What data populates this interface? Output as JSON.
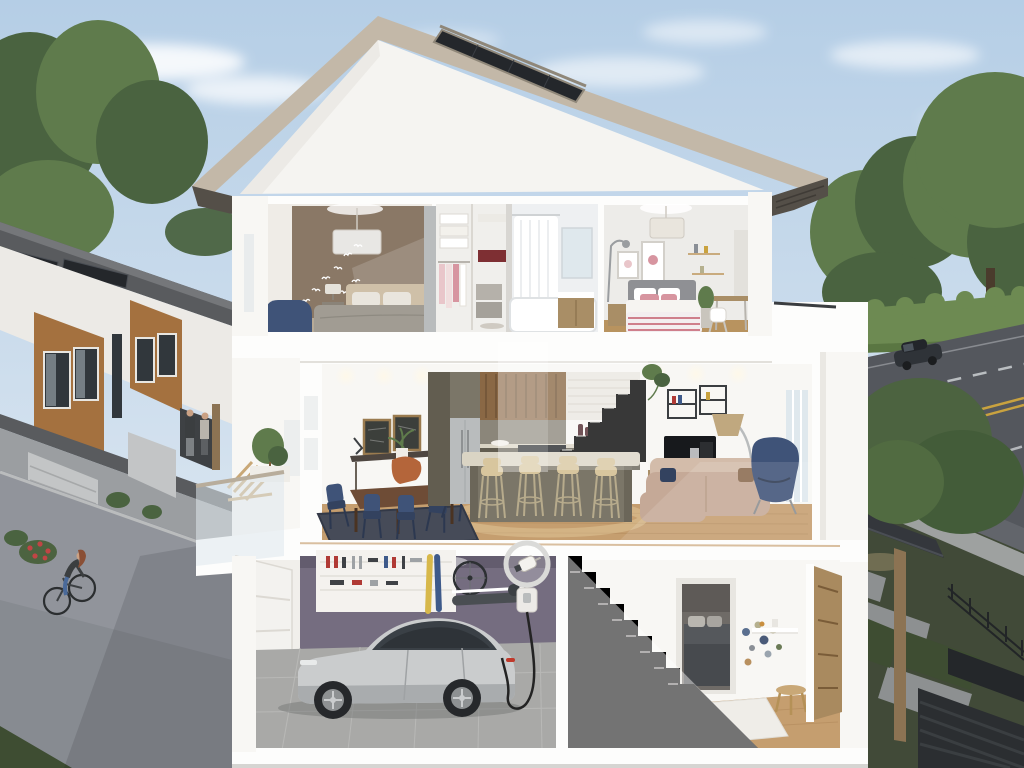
{
  "meta": {
    "description": "Photorealistic 3D cutaway cross-section rendering of a three-storey townhouse: furnished bedrooms and bath upstairs, kitchen-dining-living main floor, garage with charging electric car below; neighbouring solar-roof townhomes and a cyclist on the left laneway, tree-lined road with cars on the right",
    "style": "architectural rendering",
    "text_visible": "none"
  },
  "palette": {
    "sky_top": "#b5cee6",
    "sky_bot": "#e7eef4",
    "cloud": "#ffffff",
    "tree": "#5f7b4c",
    "tree_dark": "#4a6340",
    "tree_fore": "#4c6340",
    "hedge": "#6d8a52",
    "grass": "#3e4d32",
    "roof_fascia": "#c3b8a8",
    "roof_fascia2": "#b2a694",
    "soffit": "#544f48",
    "gable": "#f5f4f1",
    "solar": "#24272b",
    "solar_frame": "#8f8779",
    "wall": "#f8f7f4",
    "wall_shade": "#eae8e3",
    "cut": "#fdfdfc",
    "edge": "#d9d6d0",
    "taupe": "#8a7866",
    "carpet": "#b7aa97",
    "woodf": "#c59e6f",
    "woodf2": "#b8935f",
    "bed_gray": "#a19c93",
    "bed_dark": "#74706a",
    "linen": "#e9e5dd",
    "headboard": "#cfc0a8",
    "navy": "#3f5378",
    "navy_dark": "#33425f",
    "pink_light": "#e9c6ca",
    "pink": "#d795a0",
    "bath": "#eef0f2",
    "mirror": "#dfe8ed",
    "vanity": "#a98e66",
    "wall2": "#edece9",
    "bed2": "#8f9094",
    "stripe": "#cf7f8c",
    "cabinet": "#7b7668",
    "cabinet_dk": "#625d50",
    "slatwood": "#8a6845",
    "counter": "#dad4c4",
    "stool": "#d8c69e",
    "steel": "#b9bcbd",
    "tablewood": "#6e4c36",
    "rug": "#464b58",
    "chalk": "#3c3f3b",
    "orange": "#b4653a",
    "sofa": "#c5a997",
    "sofa_lt": "#d3bcaa",
    "console": "#a98e66",
    "tv": "#17191c",
    "gold": "#c0a87f",
    "purple": "#756d80",
    "purple_dk": "#635c6e",
    "gfloor": "#a9a9a7",
    "gtile": "#999997",
    "silver": "#cacccd",
    "silver_dk": "#a9acae",
    "glass": "#3a4046",
    "tire": "#26282b",
    "door": "#a98a5f",
    "asphalt": "#91949b",
    "asphalt_dk": "#7e8188",
    "curb": "#babcbd",
    "road": "#54575d",
    "line_y": "#c9a23f",
    "line_w": "#ccd0d3",
    "troof": "#75777a",
    "troof_dk": "#595b5e",
    "twood": "#a4713f",
    "twhite": "#eceae6",
    "tgray": "#9b9ea1",
    "tgarage": "#c3c5c6",
    "twin": "#31373c",
    "fence": "#2b2e31",
    "porch": "#34373c",
    "post": "#8c7353",
    "red": "#b03a35",
    "ski_y": "#d7b84a",
    "ski_b": "#3e5a8a",
    "cable": "#232323",
    "skin": "#caa184",
    "hair": "#8a4f35",
    "jeans": "#4a6a9a",
    "jacket": "#3b3e40"
  },
  "scene": {
    "environment": {
      "sky": "clear blue with soft clouds",
      "left": {
        "townhouse_row": {
          "roof_solar_panels": 2,
          "wood_clad_window_bays": 2,
          "garage_doors": 2,
          "people_at_entry": 2
        },
        "laneway": {
          "cyclist": 1,
          "flower_bush": "red blooms"
        }
      },
      "right": {
        "road": {
          "cars": 2,
          "markings": [
            "double yellow centerline",
            "white dashed lane lines"
          ]
        },
        "hedge": true,
        "trees": true,
        "backyard": {
          "porch_canopy": true,
          "wood_post": true,
          "metal_fence": true,
          "horizontal_slat_fence": true,
          "concrete_pavers": true
        }
      }
    },
    "house": {
      "type": "three-storey cutaway cross-section",
      "roof": {
        "shape": "gable",
        "solar_panel": 1
      },
      "floors": [
        {
          "name": "upper floor",
          "rooms": [
            {
              "name": "master bedroom",
              "objects": [
                "pendant light",
                "bird wall decals",
                "double bed",
                "blue armchair",
                "nightstand with lamp",
                "taupe accent wall"
              ]
            },
            {
              "name": "walk-in closet",
              "objects": [
                "folded linens",
                "hanging clothes",
                "drawer unit",
                "open shelving"
              ]
            },
            {
              "name": "bathroom",
              "objects": [
                "bathtub with shower curtain",
                "wood vanity",
                "mirror"
              ]
            },
            {
              "name": "second bedroom",
              "objects": [
                "pendant light",
                "bed with pink pillows and striped throw",
                "framed art",
                "wall shelves",
                "desk with chair",
                "potted plant",
                "floor lamp"
              ]
            }
          ]
        },
        {
          "name": "main floor",
          "rooms": [
            {
              "name": "balcony",
              "objects": [
                "glass railing",
                "wood slat chair",
                "potted olive tree"
              ]
            },
            {
              "name": "dining area",
              "objects": [
                "chalkboard frames",
                "console desk",
                "orange chair",
                "wood dining table",
                "navy chairs",
                "dark blue rug"
              ]
            },
            {
              "name": "kitchen",
              "objects": [
                "olive cabinetry",
                "stainless fridge",
                "wood slat feature panel",
                "island with waterfall counter",
                "bar stools x4",
                "cooktop",
                "red coffee maker",
                "wine bottles"
              ]
            },
            {
              "name": "living area",
              "objects": [
                "wall shelf with plant",
                "flat-screen TV",
                "wood media console",
                "tan sofa",
                "navy wing chair",
                "arc floor lamp",
                "leaning art frames"
              ]
            },
            {
              "name": "staircase",
              "objects": [
                "white stairs"
              ]
            }
          ]
        },
        {
          "name": "ground floor",
          "rooms": [
            {
              "name": "garage",
              "objects": [
                "silver electric car",
                "EV wall charger with magnifier callout",
                "charging cable",
                "garage door",
                "tool pegboard",
                "skis",
                "mounted bicycle wheel",
                "snowboard shelf",
                "purple feature wall",
                "grey tile floor"
              ]
            },
            {
              "name": "staircase",
              "objects": [
                "white stairs"
              ]
            },
            {
              "name": "hallway",
              "objects": [
                "doorway to dark-bed bedroom",
                "coloured wall dot decals",
                "floating shelf",
                "wood stool",
                "white rug",
                "wood front door"
              ]
            }
          ]
        }
      ]
    }
  }
}
